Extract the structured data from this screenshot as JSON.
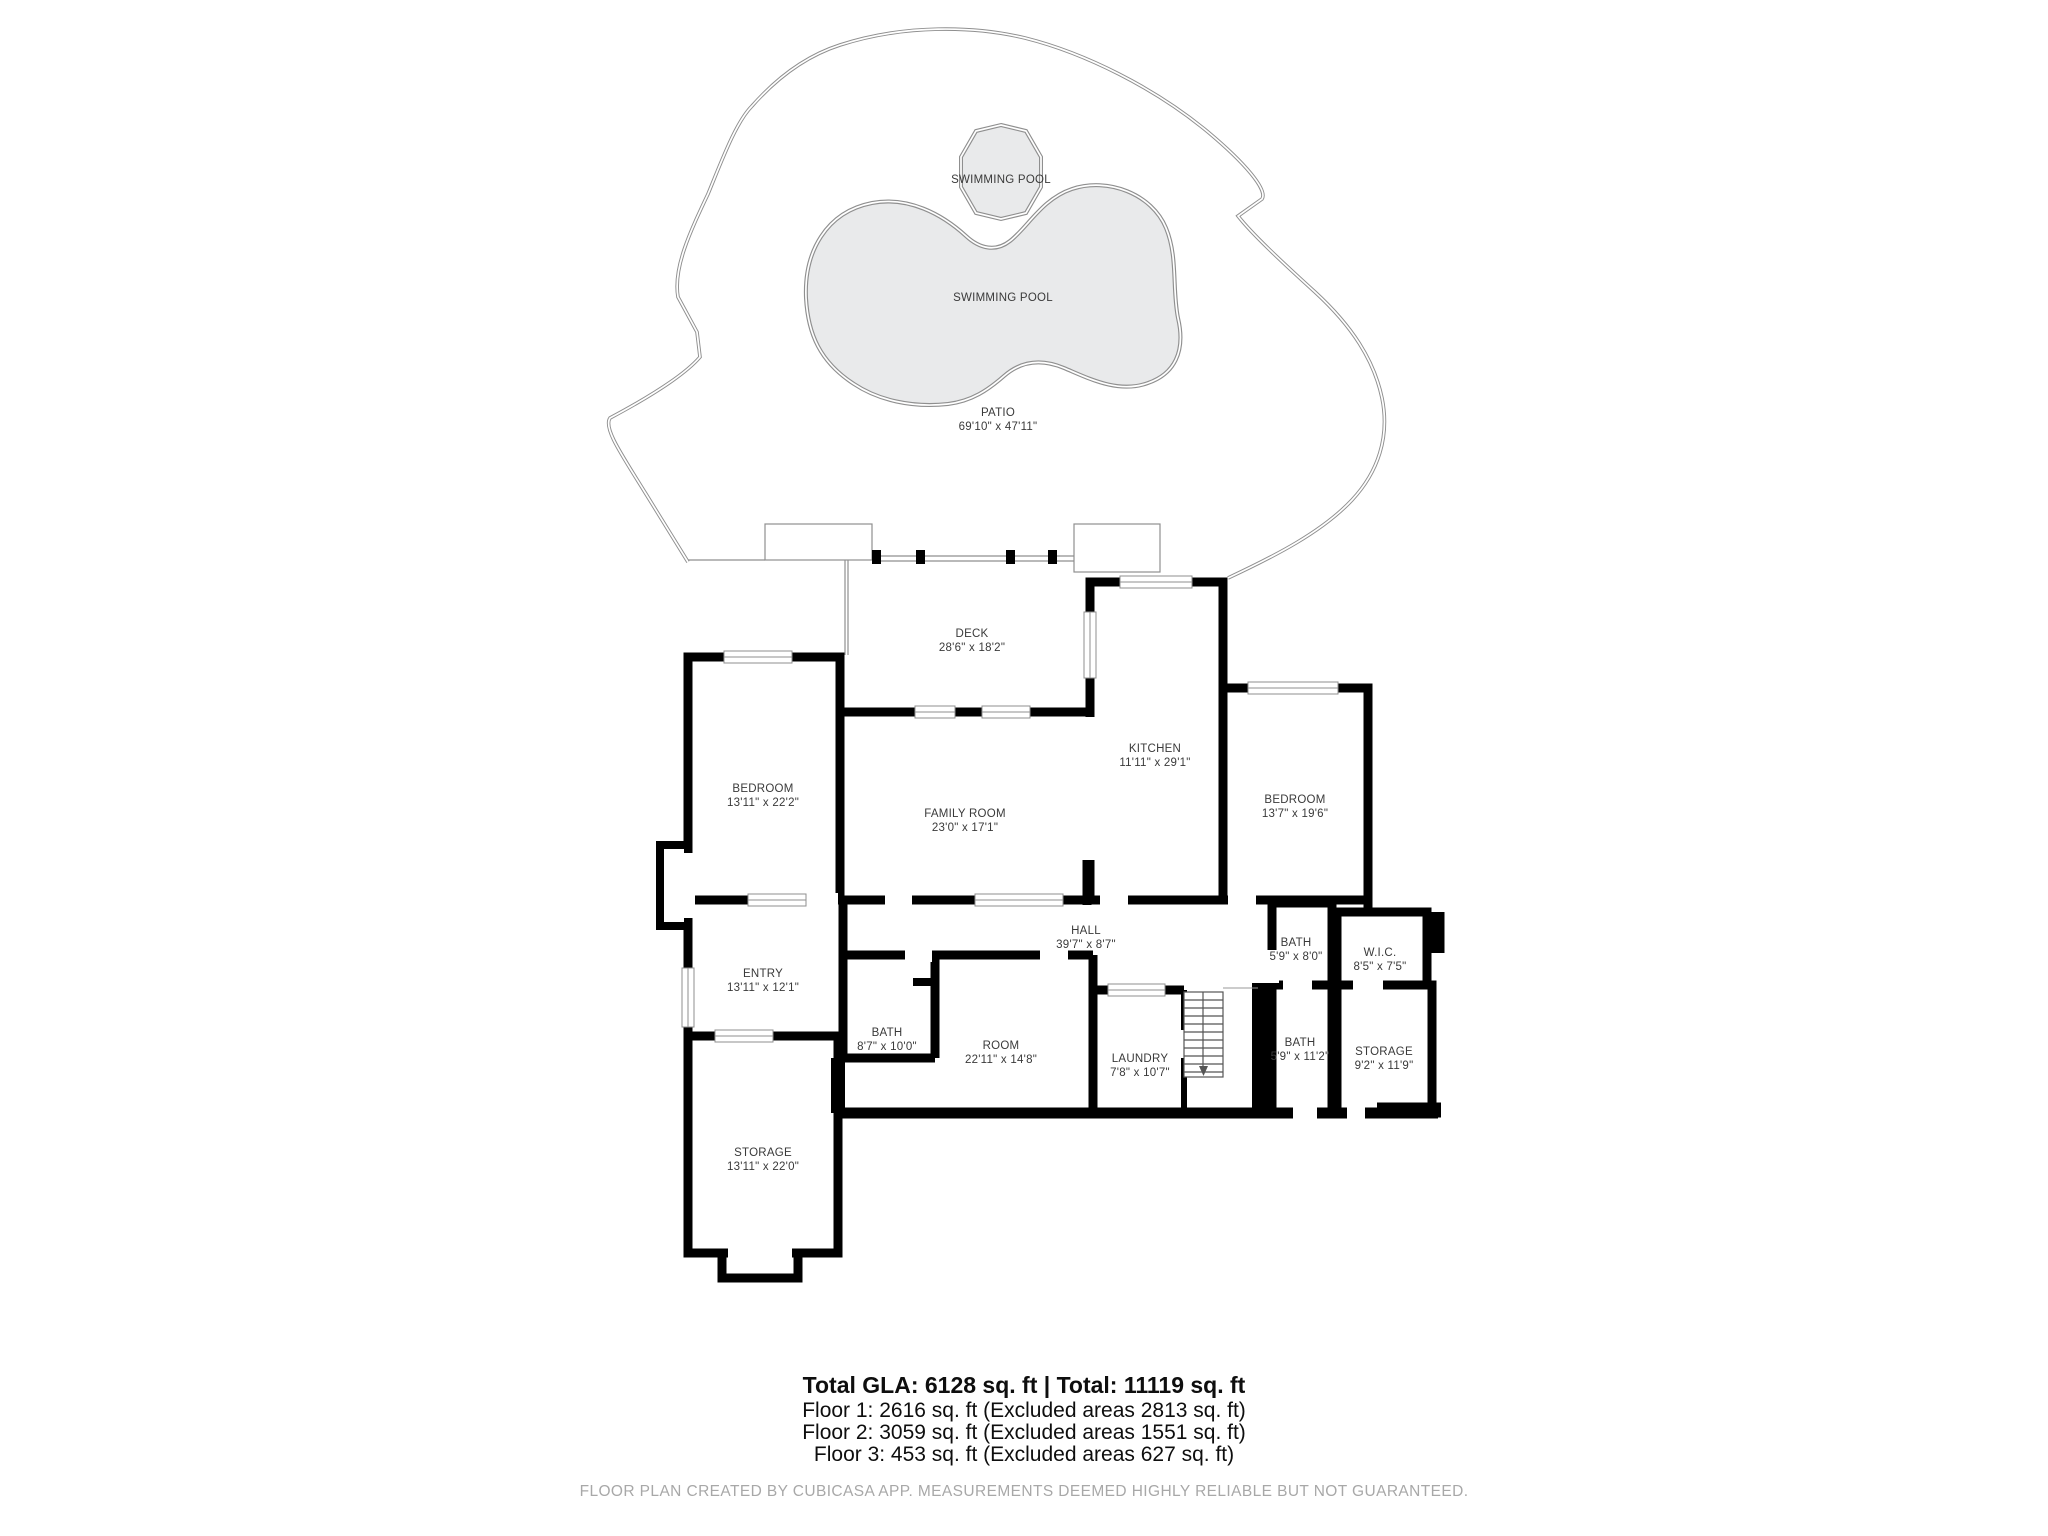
{
  "fp": {
    "rooms": [
      {
        "id": "pool-small",
        "label": "SWIMMING POOL",
        "dims": ""
      },
      {
        "id": "pool-large",
        "label": "SWIMMING POOL",
        "dims": ""
      },
      {
        "id": "patio",
        "label": "PATIO",
        "dims": "69'10\" x 47'11\""
      },
      {
        "id": "deck",
        "label": "DECK",
        "dims": "28'6\" x 18'2\""
      },
      {
        "id": "bedroom-left",
        "label": "BEDROOM",
        "dims": "13'11\" x 22'2\""
      },
      {
        "id": "family-room",
        "label": "FAMILY ROOM",
        "dims": "23'0\" x 17'1\""
      },
      {
        "id": "kitchen",
        "label": "KITCHEN",
        "dims": "11'11\" x 29'1\""
      },
      {
        "id": "bedroom-right",
        "label": "BEDROOM",
        "dims": "13'7\" x 19'6\""
      },
      {
        "id": "hall",
        "label": "HALL",
        "dims": "39'7\" x 8'7\""
      },
      {
        "id": "bath-top",
        "label": "BATH",
        "dims": "5'9\" x 8'0\""
      },
      {
        "id": "wic",
        "label": "W.I.C.",
        "dims": "8'5\" x 7'5\""
      },
      {
        "id": "entry",
        "label": "ENTRY",
        "dims": "13'11\" x 12'1\""
      },
      {
        "id": "bath-mid",
        "label": "BATH",
        "dims": "8'7\" x 10'0\""
      },
      {
        "id": "room",
        "label": "ROOM",
        "dims": "22'11\" x 14'8\""
      },
      {
        "id": "laundry",
        "label": "LAUNDRY",
        "dims": "7'8\" x 10'7\""
      },
      {
        "id": "bath-bottom",
        "label": "BATH",
        "dims": "5'9\" x 11'2\""
      },
      {
        "id": "storage-right",
        "label": "STORAGE",
        "dims": "9'2\" x 11'9\""
      },
      {
        "id": "storage-bottom",
        "label": "STORAGE",
        "dims": "13'11\" x 22'0\""
      }
    ],
    "summary": {
      "total": "Total GLA: 6128 sq. ft | Total: 11119 sq. ft",
      "floors": [
        "Floor 1: 2616 sq. ft (Excluded areas 2813 sq. ft)",
        "Floor 2: 3059 sq. ft (Excluded areas 1551 sq. ft)",
        "Floor 3: 453 sq. ft (Excluded areas 627 sq. ft)"
      ]
    },
    "disclaimer": "FLOOR PLAN CREATED BY CUBICASA APP. MEASUREMENTS DEEMED HIGHLY RELIABLE BUT NOT GUARANTEED.",
    "colors": {
      "wall": "#000000",
      "pool_fill": "#e9eaeb",
      "thin_outline": "#8f8f8f",
      "label_text": "#3a3a3a",
      "disclaimer_text": "#a8a8a8"
    }
  }
}
